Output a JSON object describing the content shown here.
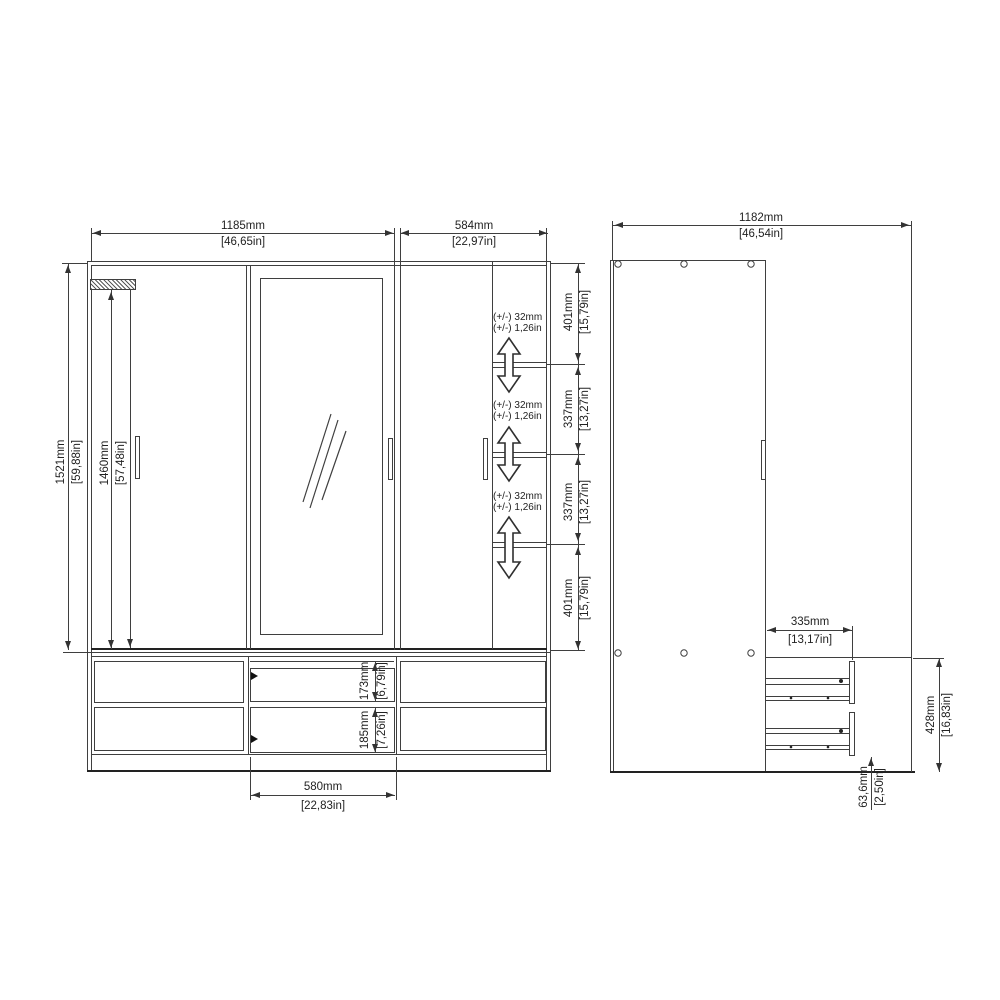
{
  "drawing_title": "wardrobe-technical-drawing",
  "front_view": {
    "dims": {
      "width_left": {
        "mm": "1185mm",
        "in": "[46,65in]"
      },
      "width_right": {
        "mm": "584mm",
        "in": "[22,97in]"
      },
      "height_total": {
        "mm": "1521mm",
        "in": "[59,88in]"
      },
      "height_interior": {
        "mm": "1460mm",
        "in": "[57,48in]"
      },
      "shelf_spacing": [
        {
          "mm": "401mm",
          "in": "[15,79in]"
        },
        {
          "mm": "337mm",
          "in": "[13,27in]"
        },
        {
          "mm": "337mm",
          "in": "[13,27in]"
        },
        {
          "mm": "401mm",
          "in": "[15,79in]"
        }
      ],
      "tolerance": {
        "mm": "(+/-) 32mm",
        "in": "(+/-) 1,26in"
      },
      "drawer_top": {
        "mm": "173mm",
        "in": "[6,79in]"
      },
      "drawer_bottom": {
        "mm": "185mm",
        "in": "[7,26in]"
      },
      "drawer_width": {
        "mm": "580mm",
        "in": "[22,83in]"
      }
    }
  },
  "side_view": {
    "dims": {
      "width": {
        "mm": "1182mm",
        "in": "[46,54in]"
      },
      "drawer_depth": {
        "mm": "335mm",
        "in": "[13,17in]"
      },
      "drawer_section_height": {
        "mm": "428mm",
        "in": "[16,83in]"
      },
      "plinth_height": {
        "mm": "63,6mm",
        "in": "[2,50in]"
      }
    }
  }
}
